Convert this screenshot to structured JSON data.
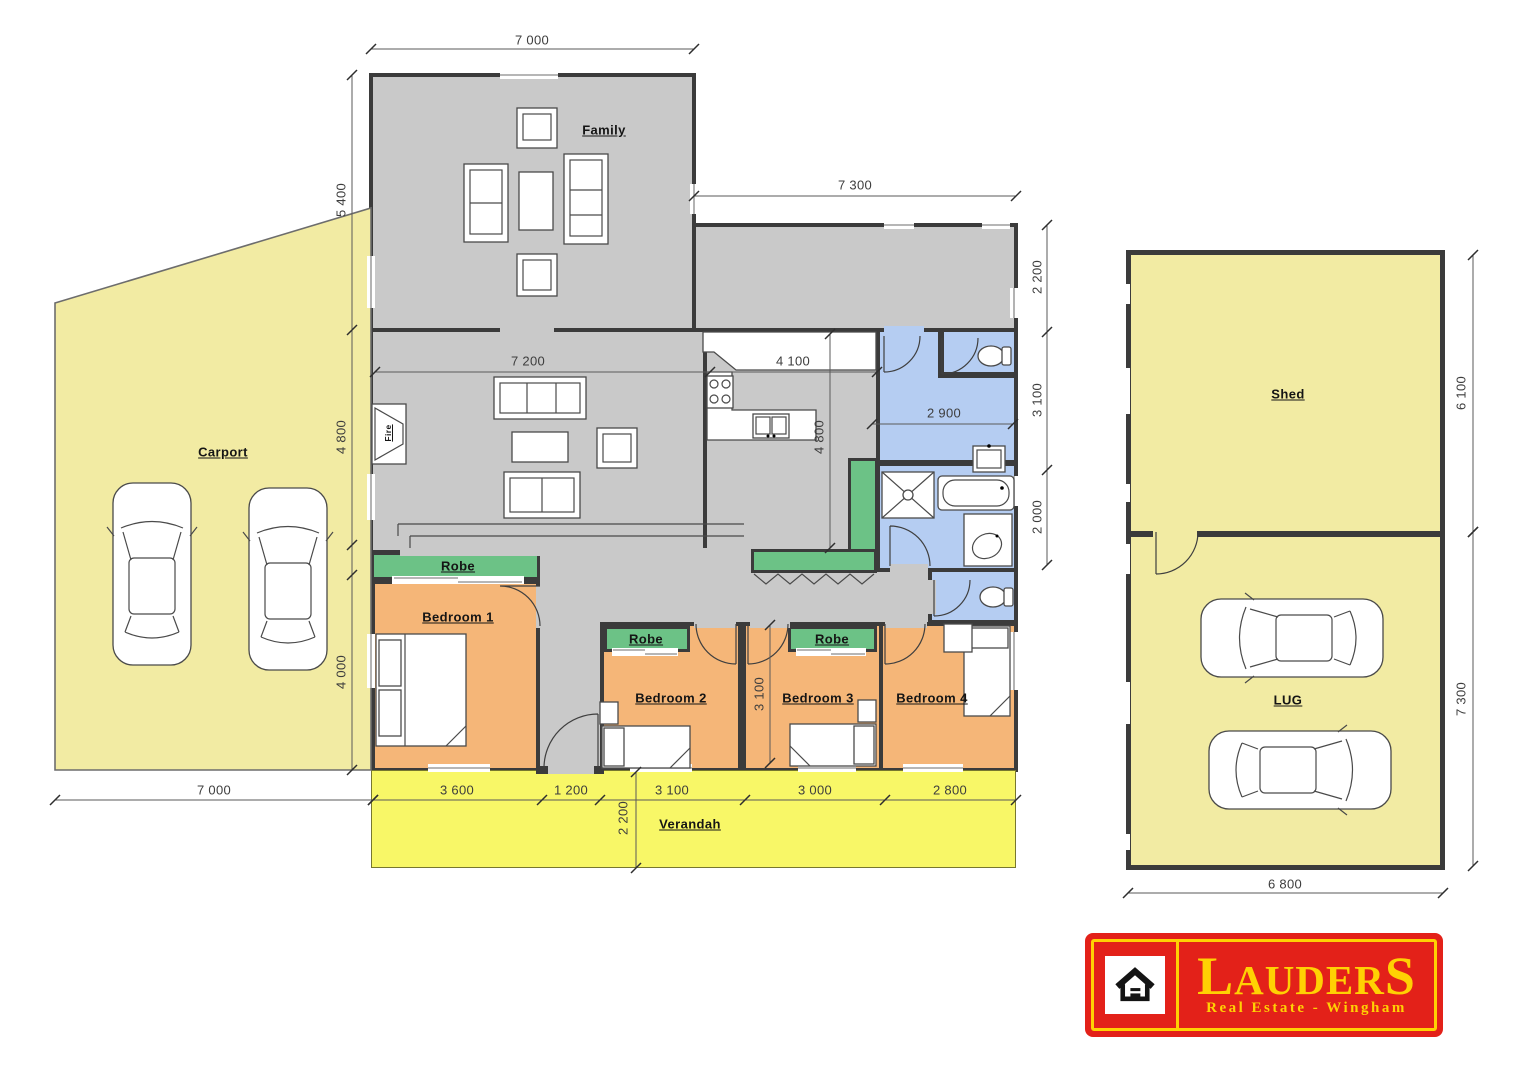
{
  "plan": {
    "labels": {
      "family": "Family",
      "carport": "Carport",
      "robe": "Robe",
      "bedroom1": "Bedroom 1",
      "bedroom2": "Bedroom 2",
      "bedroom3": "Bedroom 3",
      "bedroom4": "Bedroom 4",
      "verandah": "Verandah",
      "shed": "Shed",
      "lug": "LUG",
      "fire": "Fire"
    },
    "dimensions": {
      "family_width": "7 000",
      "meals_width": "7 300",
      "family_depth": "5 400",
      "living_depth": "4 800",
      "bedrooms_depth": "4 000",
      "meals_depth": "2 200",
      "bath_zone_depth": "3 100",
      "bath_depth": "2 000",
      "living_width": "7 200",
      "kitchen_width": "4 100",
      "kitchen_depth": "4 800",
      "laundry_width": "2 900",
      "bedroom3_depth": "3 100",
      "bedroom1_width": "3 600",
      "hall_width": "1 200",
      "bedroom2_width": "3 100",
      "bedroom3_width": "3 000",
      "bedroom4_width": "2 800",
      "verandah_depth": "2 200",
      "carport_width": "7 000",
      "shed_depth": "6 100",
      "garage_depth": "7 300",
      "garage_width": "6 800"
    }
  },
  "logo": {
    "brand": "LAUDERS",
    "tagline": "Real Estate - Wingham"
  },
  "colors": {
    "wall": "#3b3b3b",
    "floor": "#c9c9c9",
    "bedroom": "#f5b678",
    "robe": "#6cc286",
    "bath": "#b5cdf2",
    "verandah": "#f8f767",
    "yard": "#f2eba3",
    "logo_red": "#e32119",
    "logo_yellow": "#ffd103"
  }
}
